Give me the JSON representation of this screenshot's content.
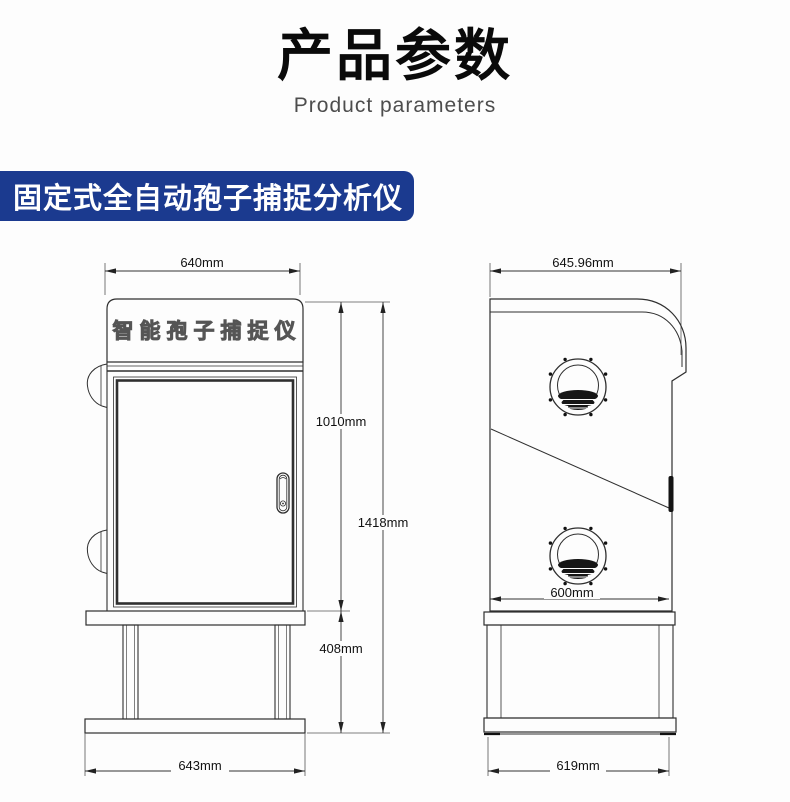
{
  "header": {
    "title": "产品参数",
    "subtitle": "Product parameters"
  },
  "banner": {
    "label": "固定式全自动孢子捕捉分析仪"
  },
  "colors": {
    "accent_blue": "#1b3a8f",
    "line": "#2f2f2f",
    "background": "#fdfdfd"
  },
  "views": {
    "front": {
      "panel_label": "智能孢子捕捉仪",
      "dims": {
        "top_width": "640mm",
        "door_height": "1010mm",
        "total_height": "1418mm",
        "stand_height": "408mm",
        "base_width": "643mm"
      }
    },
    "side": {
      "dims": {
        "top_width": "645.96mm",
        "body_width": "600mm",
        "base_width": "619mm"
      }
    }
  }
}
